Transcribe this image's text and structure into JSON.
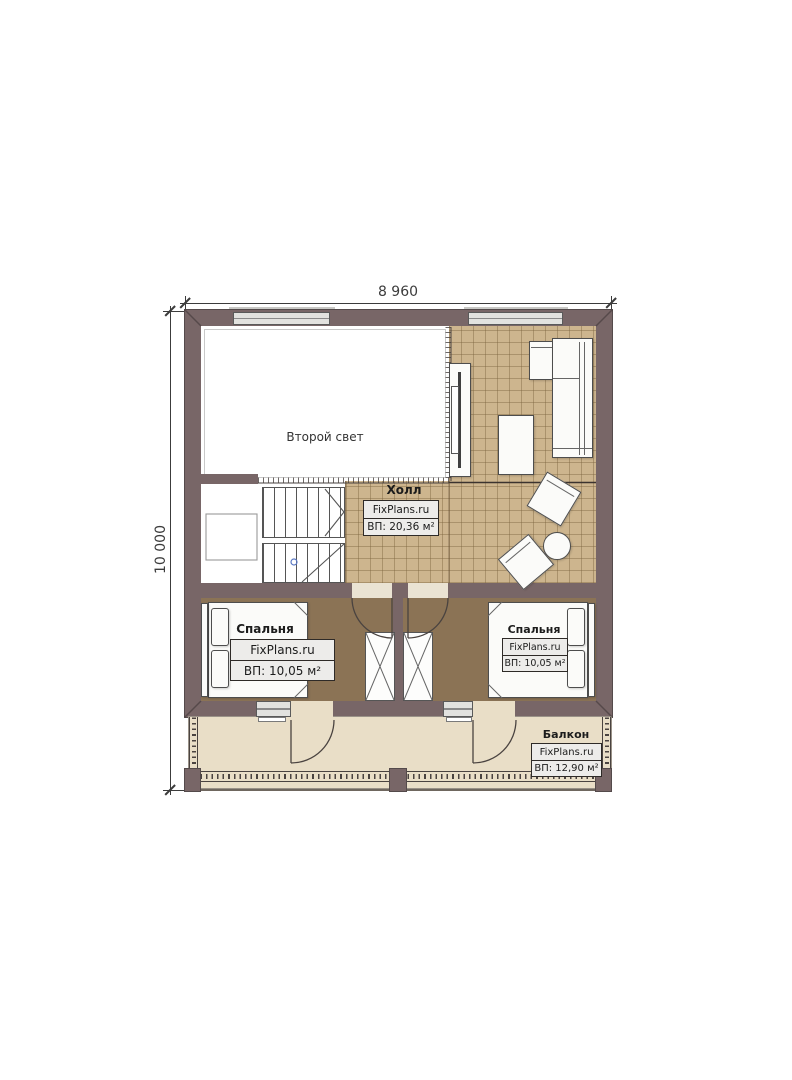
{
  "dimensions": {
    "top": "8 960",
    "left": "10 000"
  },
  "rooms": {
    "void": {
      "label": "Второй свет"
    },
    "hall": {
      "title": "Холл",
      "brand": "FixPlans.ru",
      "area": "ВП: 20,36 м²"
    },
    "bedroom_left": {
      "title": "Спальня",
      "brand": "FixPlans.ru",
      "area": "ВП: 10,05 м²"
    },
    "bedroom_right": {
      "title": "Спальня",
      "brand": "FixPlans.ru",
      "area": "ВП: 10,05 м²"
    },
    "balcony": {
      "title": "Балкон",
      "brand": "FixPlans.ru",
      "area": "ВП: 12,90 м²"
    }
  },
  "colors": {
    "wall": "#786667",
    "wall_dark": "#544a4b",
    "tile_floor": "#cdb58e",
    "tile_line": "rgba(122,98,60,0.42)",
    "bedroom_floor": "#8b7355",
    "balcony_floor": "#e9dec7",
    "void_floor": "#ffffff",
    "door_gap": "#eae3d3",
    "window_fill": "#e2e2df",
    "furniture_fill": "#fbfbf9",
    "furniture_line": "#4d4d4d",
    "label_bg": "#edecea",
    "label_border": "#2e2a27",
    "dim": "#3c3c3c"
  }
}
